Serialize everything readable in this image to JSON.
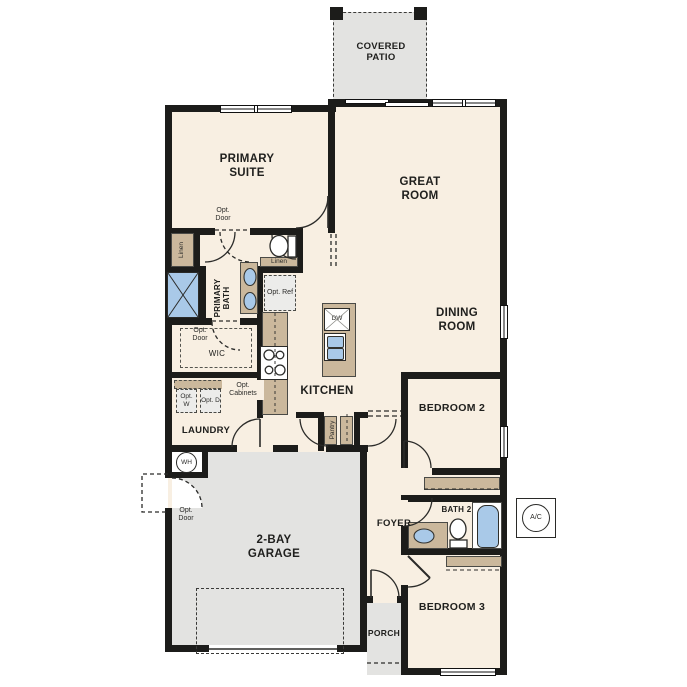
{
  "floorplan": {
    "rooms": {
      "covered_patio": "COVERED PATIO",
      "primary_suite": "PRIMARY SUITE",
      "great_room": "GREAT ROOM",
      "dining_room": "DINING ROOM",
      "kitchen": "KITCHEN",
      "primary_bath": "PRIMARY BATH",
      "wic": "WIC",
      "laundry": "LAUNDRY",
      "pantry": "Pantry",
      "foyer": "FOYER",
      "garage": "2-BAY GARAGE",
      "porch": "PORCH",
      "bedroom2": "BEDROOM 2",
      "bedroom3": "BEDROOM 3",
      "bath2": "BATH 2"
    },
    "annotations": {
      "opt_door": "Opt. Door",
      "opt_ref": "Opt. Ref",
      "opt_cabinets": "Opt. Cabinets",
      "opt_washer": "Opt. W",
      "opt_dryer": "Opt. D",
      "linen": "Linen",
      "water_heater": "WH",
      "dishwasher": "DW",
      "ac_unit": "A/C"
    },
    "colors": {
      "wall": "#1c1c1a",
      "interior_floor": "#f8efe2",
      "exterior_concrete": "#e3e3e1",
      "casework_tan": "#cbb89c",
      "plumbing_blue": "#a9c9e8"
    }
  }
}
